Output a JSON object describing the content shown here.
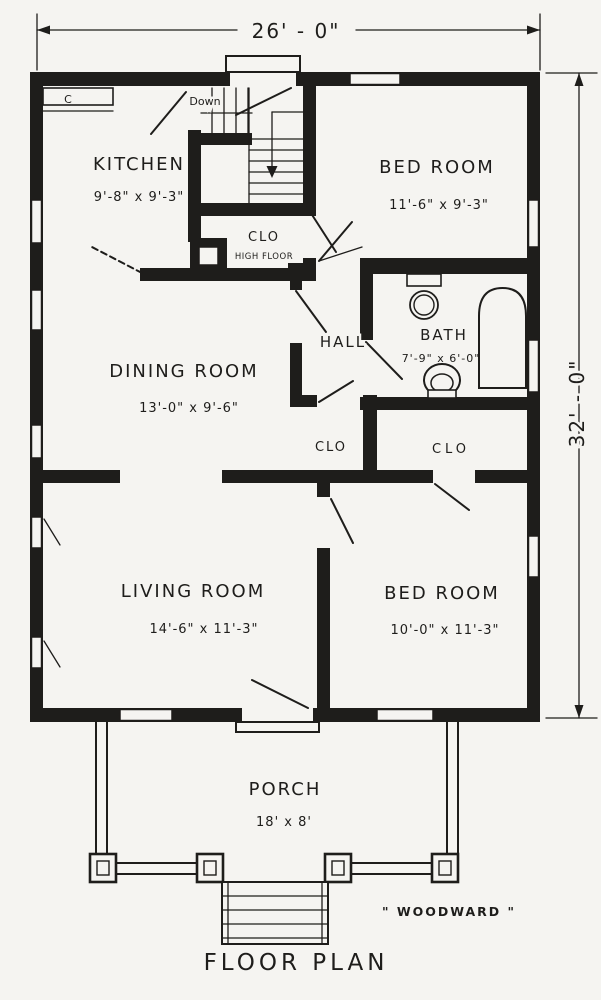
{
  "colors": {
    "ink": "#1e1d1b",
    "paper": "#f5f4f1"
  },
  "dimensions": {
    "width_label": "26' - 0\"",
    "depth_label": "32' - 0\""
  },
  "rooms": {
    "kitchen": {
      "name": "KITCHEN",
      "size": "9'-8\" x 9'-3\""
    },
    "bedroom1": {
      "name": "BED ROOM",
      "size": "11'-6\" x 9'-3\""
    },
    "dining": {
      "name": "DINING ROOM",
      "size": "13'-0\" x 9'-6\""
    },
    "bath": {
      "name": "BATH",
      "size": "7'-9\" x 6'-0\""
    },
    "hall": {
      "name": "HALL"
    },
    "living": {
      "name": "LIVING ROOM",
      "size": "14'-6\" x 11'-3\""
    },
    "bedroom2": {
      "name": "BED ROOM",
      "size": "10'-0\" x 11'-3\""
    },
    "porch": {
      "name": "PORCH",
      "size": "18' x 8'"
    }
  },
  "closets": {
    "hall_closet": "CLO",
    "bedroom_closet": "CLO",
    "stair_closet": "CLO",
    "stair_closet_note": "HIGH FLOOR",
    "kitchen_cabinet": "C"
  },
  "stairs": {
    "down_label": "Down"
  },
  "title": "FLOOR PLAN",
  "signature": "\" WOODWARD \""
}
